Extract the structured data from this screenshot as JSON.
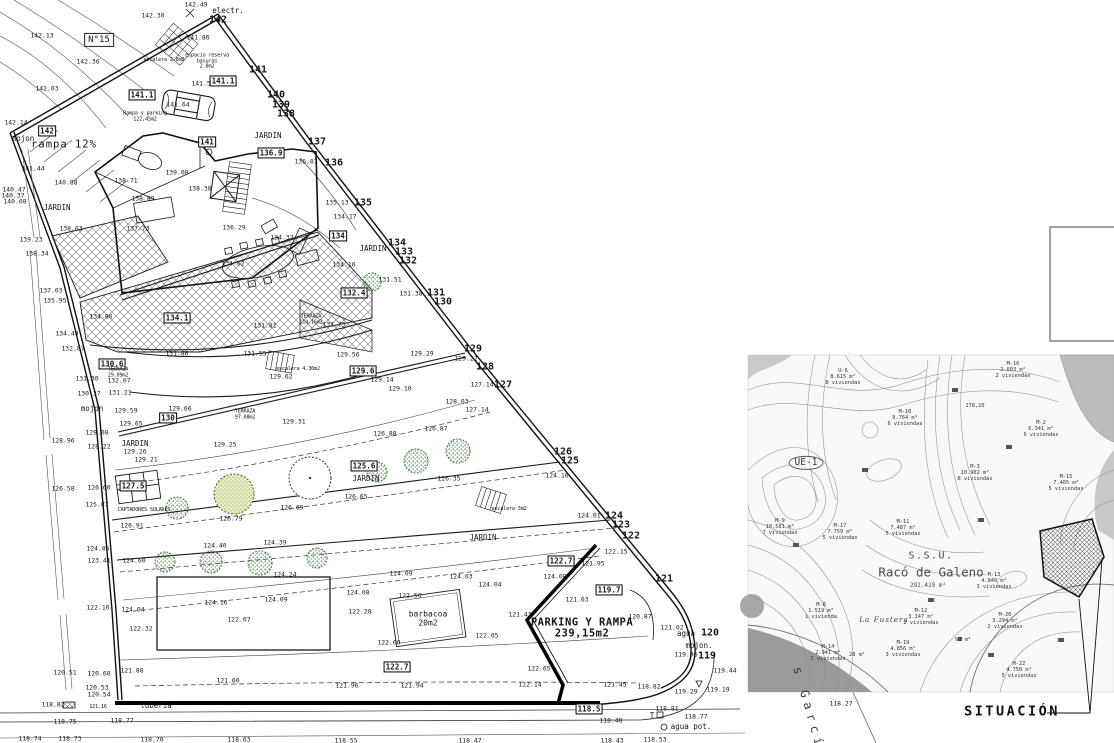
{
  "colors": {
    "line": "#1a1a1a",
    "tree_green": "#2c7a2c",
    "hatch": "#777777",
    "map_gray": "#9a9a9a"
  },
  "plan": {
    "labels": [
      {
        "t": "142.13",
        "x": 42,
        "y": 36
      },
      {
        "t": "N°15",
        "x": 99,
        "y": 40,
        "c": "n15"
      },
      {
        "t": "142.36",
        "x": 88,
        "y": 62
      },
      {
        "t": "142.03",
        "x": 47,
        "y": 89
      },
      {
        "t": "142.14",
        "x": 16,
        "y": 123
      },
      {
        "t": "142.30",
        "x": 153,
        "y": 16
      },
      {
        "t": "142.49",
        "x": 196,
        "y": 5
      },
      {
        "t": "electr.",
        "x": 228,
        "y": 11,
        "c": "nm"
      },
      {
        "t": "142",
        "x": 218,
        "y": 21,
        "c": "b"
      },
      {
        "t": "141.86",
        "x": 198,
        "y": 38
      },
      {
        "t": "escalera 2.8m2",
        "x": 164,
        "y": 61,
        "c": "t5"
      },
      {
        "t": "espacio reserva\nbasuras\n2.8m2",
        "x": 207,
        "y": 62,
        "c": "t5"
      },
      {
        "t": "141",
        "x": 258,
        "y": 71,
        "c": "b"
      },
      {
        "t": "141.53",
        "x": 203,
        "y": 84
      },
      {
        "t": "141.1",
        "x": 223,
        "y": 81,
        "c": "box"
      },
      {
        "t": "141.1",
        "x": 142,
        "y": 95,
        "c": "box"
      },
      {
        "t": "140",
        "x": 276,
        "y": 96,
        "c": "b"
      },
      {
        "t": "139",
        "x": 281,
        "y": 106,
        "c": "b"
      },
      {
        "t": "138",
        "x": 286,
        "y": 115,
        "c": "b"
      },
      {
        "t": "141.64",
        "x": 178,
        "y": 105
      },
      {
        "t": "Rampa y parking\n122,45m2",
        "x": 145,
        "y": 117,
        "c": "t5"
      },
      {
        "t": "142",
        "x": 47,
        "y": 131,
        "c": "box"
      },
      {
        "t": "mojon",
        "x": 23,
        "y": 139,
        "c": "nm"
      },
      {
        "t": "rampa 12%",
        "x": 64,
        "y": 145,
        "c": "big"
      },
      {
        "t": "141.44",
        "x": 33,
        "y": 169
      },
      {
        "t": "140.88",
        "x": 66,
        "y": 183
      },
      {
        "t": "140.47",
        "x": 14,
        "y": 190
      },
      {
        "t": "140.37",
        "x": 13,
        "y": 196
      },
      {
        "t": "140.08",
        "x": 15,
        "y": 202
      },
      {
        "t": "JARDIN",
        "x": 57,
        "y": 208,
        "c": "nm"
      },
      {
        "t": "JARDIN",
        "x": 268,
        "y": 136,
        "c": "nm"
      },
      {
        "t": "141",
        "x": 207,
        "y": 142,
        "c": "box"
      },
      {
        "t": "136.9",
        "x": 271,
        "y": 153,
        "c": "box"
      },
      {
        "t": "137",
        "x": 317,
        "y": 143,
        "c": "b"
      },
      {
        "t": "136.87",
        "x": 306,
        "y": 162
      },
      {
        "t": "136",
        "x": 334,
        "y": 164,
        "c": "b"
      },
      {
        "t": "139.08",
        "x": 177,
        "y": 173
      },
      {
        "t": "138.71",
        "x": 126,
        "y": 181
      },
      {
        "t": "138.89",
        "x": 143,
        "y": 199
      },
      {
        "t": "138.38",
        "x": 200,
        "y": 189
      },
      {
        "t": "135.13",
        "x": 337,
        "y": 203
      },
      {
        "t": "135",
        "x": 363,
        "y": 204,
        "c": "b"
      },
      {
        "t": "134.17",
        "x": 345,
        "y": 217
      },
      {
        "t": "137.73",
        "x": 138,
        "y": 229
      },
      {
        "t": "138.63",
        "x": 71,
        "y": 229
      },
      {
        "t": "139.23",
        "x": 31,
        "y": 240
      },
      {
        "t": "138.34",
        "x": 37,
        "y": 254
      },
      {
        "t": "136.29",
        "x": 234,
        "y": 228
      },
      {
        "t": "134",
        "x": 338,
        "y": 236,
        "c": "box"
      },
      {
        "t": "134.37",
        "x": 282,
        "y": 238
      },
      {
        "t": "134.62",
        "x": 233,
        "y": 264
      },
      {
        "t": "134.10",
        "x": 344,
        "y": 265
      },
      {
        "t": "JARDIN",
        "x": 373,
        "y": 249,
        "c": "nm"
      },
      {
        "t": "134",
        "x": 397,
        "y": 244,
        "c": "b"
      },
      {
        "t": "133",
        "x": 404,
        "y": 253,
        "c": "b"
      },
      {
        "t": "132",
        "x": 408,
        "y": 262,
        "c": "b"
      },
      {
        "t": "131.51",
        "x": 390,
        "y": 280
      },
      {
        "t": "132.4",
        "x": 354,
        "y": 293,
        "c": "box"
      },
      {
        "t": "131.38",
        "x": 411,
        "y": 294
      },
      {
        "t": "131",
        "x": 436,
        "y": 294,
        "c": "b"
      },
      {
        "t": "130",
        "x": 443,
        "y": 303,
        "c": "b"
      },
      {
        "t": "137.03",
        "x": 51,
        "y": 291
      },
      {
        "t": "135.95",
        "x": 55,
        "y": 301
      },
      {
        "t": "134.86",
        "x": 101,
        "y": 317
      },
      {
        "t": "134.1",
        "x": 177,
        "y": 318,
        "c": "box"
      },
      {
        "t": "131.81",
        "x": 265,
        "y": 326
      },
      {
        "t": "TERRAZA\n114.16m2",
        "x": 311,
        "y": 320,
        "c": "t5"
      },
      {
        "t": "131.73",
        "x": 334,
        "y": 325
      },
      {
        "t": "134.49",
        "x": 67,
        "y": 334
      },
      {
        "t": "132.87",
        "x": 73,
        "y": 349
      },
      {
        "t": "131.86",
        "x": 177,
        "y": 354
      },
      {
        "t": "131.55",
        "x": 255,
        "y": 354
      },
      {
        "t": "129.56",
        "x": 348,
        "y": 355
      },
      {
        "t": "129",
        "x": 473,
        "y": 350,
        "c": "b"
      },
      {
        "t": "128",
        "x": 485,
        "y": 368,
        "c": "b"
      },
      {
        "t": "127",
        "x": 503,
        "y": 386,
        "c": "b"
      },
      {
        "t": "129.29",
        "x": 422,
        "y": 354
      },
      {
        "t": "129.22",
        "x": 466,
        "y": 359
      },
      {
        "t": "130.6",
        "x": 112,
        "y": 364,
        "c": "box"
      },
      {
        "t": "TERRAZA\n29.09m2",
        "x": 118,
        "y": 373,
        "c": "t5"
      },
      {
        "t": "escalera 4.30m2",
        "x": 298,
        "y": 370,
        "c": "t5"
      },
      {
        "t": "129.62",
        "x": 281,
        "y": 377
      },
      {
        "t": "129.6",
        "x": 363,
        "y": 371,
        "c": "box"
      },
      {
        "t": "132.07",
        "x": 119,
        "y": 381
      },
      {
        "t": "131.21",
        "x": 120,
        "y": 393
      },
      {
        "t": "129.14",
        "x": 382,
        "y": 380
      },
      {
        "t": "129.10",
        "x": 400,
        "y": 389
      },
      {
        "t": "127.14",
        "x": 482,
        "y": 385
      },
      {
        "t": "131.30",
        "x": 87,
        "y": 379
      },
      {
        "t": "130.37",
        "x": 89,
        "y": 394
      },
      {
        "t": "mojon",
        "x": 92,
        "y": 409,
        "c": "nm"
      },
      {
        "t": "129.59",
        "x": 126,
        "y": 411
      },
      {
        "t": "129.66",
        "x": 180,
        "y": 409
      },
      {
        "t": "130",
        "x": 168,
        "y": 418,
        "c": "box"
      },
      {
        "t": "TERRAZA\n97.08m2",
        "x": 245,
        "y": 415,
        "c": "t5"
      },
      {
        "t": "129.31",
        "x": 294,
        "y": 422
      },
      {
        "t": "129.65",
        "x": 131,
        "y": 424
      },
      {
        "t": "129.25",
        "x": 225,
        "y": 445
      },
      {
        "t": "129.08",
        "x": 97,
        "y": 433
      },
      {
        "t": "128.96",
        "x": 63,
        "y": 441
      },
      {
        "t": "128.22",
        "x": 99,
        "y": 447
      },
      {
        "t": "JARDIN",
        "x": 135,
        "y": 444,
        "c": "nm"
      },
      {
        "t": "129.26",
        "x": 135,
        "y": 452
      },
      {
        "t": "129.21",
        "x": 146,
        "y": 460
      },
      {
        "t": "128.03",
        "x": 457,
        "y": 402
      },
      {
        "t": "127.14",
        "x": 477,
        "y": 410
      },
      {
        "t": "126.88",
        "x": 385,
        "y": 434
      },
      {
        "t": "126.87",
        "x": 436,
        "y": 429
      },
      {
        "t": "126",
        "x": 563,
        "y": 453,
        "c": "b"
      },
      {
        "t": "125",
        "x": 570,
        "y": 462,
        "c": "b"
      },
      {
        "t": "126.58",
        "x": 63,
        "y": 489
      },
      {
        "t": "126.60",
        "x": 99,
        "y": 488
      },
      {
        "t": "127.5",
        "x": 133,
        "y": 486,
        "c": "box"
      },
      {
        "t": "125.87",
        "x": 97,
        "y": 505
      },
      {
        "t": "CAPTADORES SOLARES",
        "x": 144,
        "y": 511,
        "c": "t5"
      },
      {
        "t": "126.91",
        "x": 132,
        "y": 526
      },
      {
        "t": "126.79",
        "x": 231,
        "y": 519
      },
      {
        "t": "126.69",
        "x": 292,
        "y": 508
      },
      {
        "t": "126.65",
        "x": 356,
        "y": 497
      },
      {
        "t": "125.6",
        "x": 364,
        "y": 466,
        "c": "box"
      },
      {
        "t": "JARDIN",
        "x": 366,
        "y": 479,
        "c": "nm"
      },
      {
        "t": "126.35",
        "x": 449,
        "y": 479
      },
      {
        "t": "escalera 3m2",
        "x": 509,
        "y": 510,
        "c": "t5"
      },
      {
        "t": "124.16",
        "x": 557,
        "y": 476
      },
      {
        "t": "124.01",
        "x": 589,
        "y": 516
      },
      {
        "t": "124",
        "x": 614,
        "y": 517,
        "c": "b"
      },
      {
        "t": "123",
        "x": 621,
        "y": 526,
        "c": "b"
      },
      {
        "t": "122",
        "x": 631,
        "y": 537,
        "c": "b"
      },
      {
        "t": "JARDIN",
        "x": 483,
        "y": 538,
        "c": "nm"
      },
      {
        "t": "124.85",
        "x": 98,
        "y": 549
      },
      {
        "t": "124.40",
        "x": 215,
        "y": 546
      },
      {
        "t": "124.39",
        "x": 275,
        "y": 543
      },
      {
        "t": "123.41",
        "x": 99,
        "y": 561
      },
      {
        "t": "124.60",
        "x": 134,
        "y": 561
      },
      {
        "t": "124.24",
        "x": 285,
        "y": 575
      },
      {
        "t": "122.15",
        "x": 616,
        "y": 552
      },
      {
        "t": "122.7",
        "x": 561,
        "y": 561,
        "c": "box"
      },
      {
        "t": "121.95",
        "x": 593,
        "y": 564
      },
      {
        "t": "121",
        "x": 664,
        "y": 580,
        "c": "b"
      },
      {
        "t": "124.08",
        "x": 358,
        "y": 593
      },
      {
        "t": "124.09",
        "x": 401,
        "y": 574
      },
      {
        "t": "124.03",
        "x": 461,
        "y": 577
      },
      {
        "t": "124.04",
        "x": 490,
        "y": 585
      },
      {
        "t": "124.08",
        "x": 555,
        "y": 577
      },
      {
        "t": "122.50",
        "x": 410,
        "y": 596
      },
      {
        "t": "122.28",
        "x": 360,
        "y": 612
      },
      {
        "t": "122.10",
        "x": 98,
        "y": 608
      },
      {
        "t": "124.04",
        "x": 133,
        "y": 610
      },
      {
        "t": "124.16",
        "x": 216,
        "y": 603
      },
      {
        "t": "124.09",
        "x": 276,
        "y": 600
      },
      {
        "t": "122.07",
        "x": 239,
        "y": 620
      },
      {
        "t": "122.32",
        "x": 141,
        "y": 629
      },
      {
        "t": "119.7",
        "x": 609,
        "y": 590,
        "c": "box"
      },
      {
        "t": "121.63",
        "x": 577,
        "y": 600
      },
      {
        "t": "121.43",
        "x": 520,
        "y": 615
      },
      {
        "t": "PARKING Y RAMPA\n239,15m2",
        "x": 582,
        "y": 629,
        "c": "pk"
      },
      {
        "t": "barbacoa\n20m2",
        "x": 428,
        "y": 619,
        "c": "bb"
      },
      {
        "t": "122.00",
        "x": 389,
        "y": 643
      },
      {
        "t": "122.05",
        "x": 487,
        "y": 636
      },
      {
        "t": "120.87",
        "x": 640,
        "y": 617
      },
      {
        "t": "121.02",
        "x": 672,
        "y": 628
      },
      {
        "t": "agua",
        "x": 686,
        "y": 634,
        "c": "nm"
      },
      {
        "t": "mojon.",
        "x": 699,
        "y": 646,
        "c": "nm"
      },
      {
        "t": "119.96",
        "x": 686,
        "y": 655
      },
      {
        "t": "120",
        "x": 710,
        "y": 634,
        "c": "b"
      },
      {
        "t": "119",
        "x": 707,
        "y": 657,
        "c": "b"
      },
      {
        "t": "122.7",
        "x": 397,
        "y": 667,
        "c": "box"
      },
      {
        "t": "122.65",
        "x": 539,
        "y": 669
      },
      {
        "t": "121.96",
        "x": 347,
        "y": 686
      },
      {
        "t": "121.94",
        "x": 412,
        "y": 686
      },
      {
        "t": "122.14",
        "x": 530,
        "y": 685
      },
      {
        "t": "121.45",
        "x": 615,
        "y": 685
      },
      {
        "t": "121.60",
        "x": 228,
        "y": 681
      },
      {
        "t": "120.51",
        "x": 65,
        "y": 673
      },
      {
        "t": "120.68",
        "x": 99,
        "y": 674
      },
      {
        "t": "121.88",
        "x": 132,
        "y": 671
      },
      {
        "t": "120.53",
        "x": 97,
        "y": 688
      },
      {
        "t": "120.54",
        "x": 99,
        "y": 695
      },
      {
        "t": "118.82",
        "x": 53,
        "y": 705
      },
      {
        "t": "121.16",
        "x": 98,
        "y": 708,
        "c": "t5"
      },
      {
        "t": "tuberia",
        "x": 156,
        "y": 706,
        "c": "nm"
      },
      {
        "t": "118.75",
        "x": 65,
        "y": 722
      },
      {
        "t": "118.77",
        "x": 122,
        "y": 721
      },
      {
        "t": "118.74",
        "x": 30,
        "y": 739
      },
      {
        "t": "118.73",
        "x": 70,
        "y": 739
      },
      {
        "t": "118.70",
        "x": 152,
        "y": 740
      },
      {
        "t": "118.63",
        "x": 239,
        "y": 740
      },
      {
        "t": "118.55",
        "x": 346,
        "y": 741
      },
      {
        "t": "118.47",
        "x": 470,
        "y": 741
      },
      {
        "t": "118.43",
        "x": 612,
        "y": 741
      },
      {
        "t": "118.53",
        "x": 655,
        "y": 740
      },
      {
        "t": "118.82",
        "x": 649,
        "y": 687
      },
      {
        "t": "119.29",
        "x": 686,
        "y": 692
      },
      {
        "t": "119.19",
        "x": 718,
        "y": 690
      },
      {
        "t": "119.44",
        "x": 725,
        "y": 671
      },
      {
        "t": "118.5",
        "x": 589,
        "y": 709,
        "c": "box"
      },
      {
        "t": "118.48",
        "x": 611,
        "y": 721
      },
      {
        "t": "T",
        "x": 652,
        "y": 716,
        "c": "nm"
      },
      {
        "t": "118.81",
        "x": 667,
        "y": 709
      },
      {
        "t": "118.77",
        "x": 696,
        "y": 717
      },
      {
        "t": "agua pot.",
        "x": 691,
        "y": 727,
        "c": "nm"
      },
      {
        "t": "118.27",
        "x": 841,
        "y": 704
      },
      {
        "t": "s García",
        "x": 810,
        "y": 714,
        "c": "gar",
        "r": 74
      }
    ]
  },
  "map": {
    "labels": [
      {
        "t": "U-6\n8.615 m²\n8 viviendas",
        "x": 843,
        "y": 377
      },
      {
        "t": "M-16\n2.603 m²\n2 viviendas",
        "x": 1013,
        "y": 370
      },
      {
        "t": "M-10\n9.764 m²\n6 viviendas",
        "x": 905,
        "y": 418
      },
      {
        "t": "178,20",
        "x": 975,
        "y": 406
      },
      {
        "t": "M-2\n6.341 m²\n6 viviendas",
        "x": 1041,
        "y": 429
      },
      {
        "t": "UE-1",
        "x": 806,
        "y": 463,
        "c": "ue"
      },
      {
        "t": "M-3\n10.902 m²\n8 viviendas",
        "x": 975,
        "y": 473
      },
      {
        "t": "M-15\n7.405 m²\n5 viviendas",
        "x": 1066,
        "y": 483
      },
      {
        "t": "M-9\n10.581 m²\n7 viviendas",
        "x": 780,
        "y": 527
      },
      {
        "t": "M-17\n7.759 m²\n5 viviendas",
        "x": 840,
        "y": 532
      },
      {
        "t": "M-11\n7.487 m²\n5 viviendas",
        "x": 903,
        "y": 528
      },
      {
        "t": "S.S.U.",
        "x": 931,
        "y": 557,
        "c": "mt1"
      },
      {
        "t": "Racó de Galeno",
        "x": 931,
        "y": 572,
        "c": "mt2"
      },
      {
        "t": "292.419 m²",
        "x": 928,
        "y": 586,
        "c": "mt3"
      },
      {
        "t": "M-13\n4.840 m²\n3 viviendas",
        "x": 994,
        "y": 581
      },
      {
        "t": "M-8\n1.519 m²\n1 vivienda",
        "x": 821,
        "y": 611
      },
      {
        "t": "La Fustera",
        "x": 884,
        "y": 620,
        "c": "it"
      },
      {
        "t": "M-12\n3.147 m²\n2 viviendas",
        "x": 921,
        "y": 617
      },
      {
        "t": "M-20\n3.294 m²\n2 viviendas",
        "x": 1005,
        "y": 621
      },
      {
        "t": "M-14\n2.941 m²\n2 viviendas",
        "x": 828,
        "y": 653
      },
      {
        "t": "28 m²",
        "x": 857,
        "y": 655
      },
      {
        "t": "M-19\n4.856 m²\n3 viviendas",
        "x": 903,
        "y": 649
      },
      {
        "t": "92 m²",
        "x": 963,
        "y": 640
      },
      {
        "t": "M-22\n4.750 m²\n5 viviendas",
        "x": 1019,
        "y": 670
      },
      {
        "t": "SITUACIÓN",
        "x": 1012,
        "y": 712,
        "c": "sit"
      }
    ]
  }
}
